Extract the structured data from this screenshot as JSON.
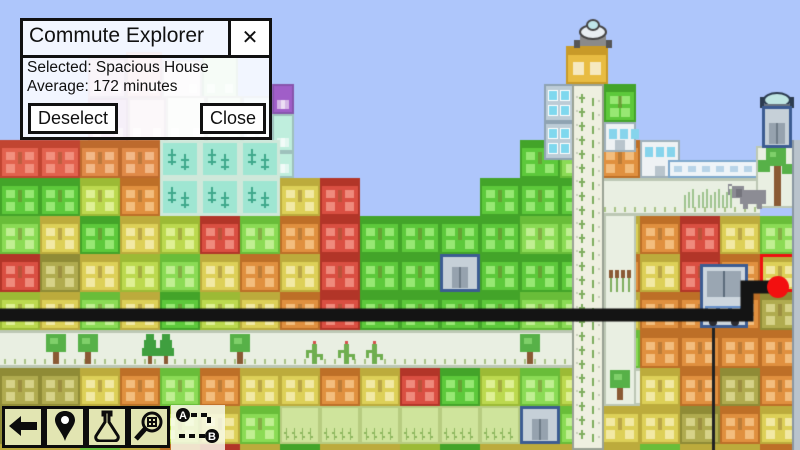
{
  "window": {
    "title": "Commute Explorer",
    "close_x": "✕",
    "selected_line": "Selected: Spacious House",
    "average_line": "Average: 172 minutes",
    "deselect_button": "Deselect",
    "close_button": "Close"
  },
  "toolbar": {
    "buttons": [
      {
        "name": "back"
      },
      {
        "name": "locate-home"
      },
      {
        "name": "research"
      },
      {
        "name": "inspect-building"
      }
    ],
    "ab_icon": {
      "a": "A",
      "b": "B"
    }
  },
  "map": {
    "sky": "#aec6fb",
    "route": {
      "color": "#141414",
      "width": 13,
      "points": [
        [
          0,
          315
        ],
        [
          747,
          315
        ],
        [
          747,
          287
        ],
        [
          770,
          287
        ]
      ],
      "dot": {
        "x": 778,
        "y": 287,
        "r": 11,
        "color": "#f31010"
      },
      "cable": {
        "x": 713,
        "y1": 328,
        "y2": 450,
        "color": "#222222"
      }
    },
    "selected_outline": "#ee1010",
    "palette": {
      "G": {
        "b": "#5dc93b",
        "d": "#43a429",
        "w": "#97e873"
      },
      "g": {
        "b": "#8bdb55",
        "d": "#69bd39",
        "w": "#c0ef92"
      },
      "L": {
        "b": "#bcd94f",
        "d": "#9cba35",
        "w": "#dff094"
      },
      "Y": {
        "b": "#ddd058",
        "d": "#bcab3c",
        "w": "#f2e9a4"
      },
      "o": {
        "b": "#b0ab4f",
        "d": "#8f8b36",
        "w": "#d6d288"
      },
      "O": {
        "b": "#e0903f",
        "d": "#bd6f27",
        "w": "#f3bd7d"
      },
      "R": {
        "b": "#da4f42",
        "d": "#b23528",
        "w": "#ef8a7c"
      },
      "r": {
        "b": "#c43c38",
        "d": "#9c2a27",
        "w": "#e07068"
      },
      "F": {
        "b": "#e2624e",
        "d": "#c14531",
        "w": "#f2907e"
      },
      "f": {
        "b": "#e08a48",
        "d": "#bd6a2d",
        "w": "#f2b887"
      },
      "X": {
        "b": "#ddd058",
        "d": "#bcab3c",
        "w": "#f2e9a4"
      }
    },
    "grid": {
      "cw": 40,
      "rh": 38,
      "y0": 140,
      "cols": [
        "FGgRLBooY",
        "FGYoYBoYY",
        "fLGYgBYog",
        "fOYLYBOgY",
        "TTLgGBgLO",
        "TTRYLBOYR",
        "TTgOYBYgY",
        ".YOYOBYAG",
        ".RRRRBOAY",
        "..GGGBYAY",
        "..GGGBRAL",
        "..GEGBGAG",
        ".GGGGBLAY",
        "GGgGgBgEY",
        "gGgGgBLgY",
        "OBYOYgpYY",
        "WBOYOOYYg",
        ".BRROOOoY",
        ".BYOOOoOY",
        "..gXoOOYO"
      ]
    },
    "decor": [
      {
        "x": 88,
        "y": 58,
        "w": 38,
        "h": 40,
        "c": "#dcc0e0"
      },
      {
        "x": 126,
        "y": 52,
        "w": 36,
        "h": 46,
        "c": "#e8c2ce"
      },
      {
        "x": 162,
        "y": 60,
        "w": 40,
        "h": 38,
        "c": "#efeaf0"
      },
      {
        "x": 202,
        "y": 56,
        "w": 36,
        "h": 42,
        "c": "#c4e8cc"
      },
      {
        "x": 88,
        "y": 98,
        "w": 40,
        "h": 44,
        "c": "#c9a2d8"
      },
      {
        "x": 128,
        "y": 98,
        "w": 38,
        "h": 44,
        "c": "#ecd2de"
      },
      {
        "x": 166,
        "y": 96,
        "w": 40,
        "h": 46,
        "c": "#e9f0e8"
      },
      {
        "x": 206,
        "y": 96,
        "w": 36,
        "h": 46,
        "c": "#d8eedc"
      },
      {
        "x": 242,
        "y": 96,
        "w": 30,
        "h": 46,
        "c": "#cfe4ef"
      },
      {
        "x": 272,
        "y": 84,
        "w": 22,
        "h": 30,
        "c": "#a05ec8"
      },
      {
        "x": 272,
        "y": 114,
        "w": 22,
        "h": 38,
        "c": "#bfeedd"
      },
      {
        "x": 272,
        "y": 152,
        "w": 22,
        "h": 26,
        "c": "#bfeedd"
      }
    ],
    "landmarks": [
      {
        "t": "ktile",
        "x": 544,
        "y": 84,
        "w": 32,
        "h": 38
      },
      {
        "t": "ktile",
        "x": 544,
        "y": 122,
        "w": 32,
        "h": 38
      },
      {
        "t": "cell",
        "c": "G",
        "x": 604,
        "y": 84,
        "w": 32,
        "h": 38
      },
      {
        "t": "cell",
        "c": "W",
        "x": 604,
        "y": 122,
        "w": 32,
        "h": 30
      },
      {
        "t": "shaft",
        "x": 572,
        "y": 84,
        "w": 32,
        "h": 366
      },
      {
        "t": "cap",
        "x": 566,
        "y": 46,
        "w": 42,
        "h": 38
      },
      {
        "t": "statue",
        "x": 572,
        "y": 18
      },
      {
        "t": "pocket",
        "x": 604,
        "y": 214,
        "w": 32,
        "h": 192
      },
      {
        "t": "wall",
        "x": 668,
        "y": 160,
        "w": 100,
        "h": 18
      },
      {
        "t": "treetile",
        "x": 756,
        "y": 146,
        "w": 38,
        "h": 62
      },
      {
        "t": "dome2",
        "x": 762,
        "y": 92
      },
      {
        "t": "cell",
        "c": "E",
        "x": 762,
        "y": 106,
        "w": 30,
        "h": 42
      },
      {
        "t": "strip",
        "x": 792,
        "y": 140,
        "w": 8,
        "h": 310
      },
      {
        "t": "garage",
        "x": 700,
        "y": 264,
        "w": 48,
        "h": 64
      },
      {
        "t": "elephant",
        "x": 740,
        "y": 184
      }
    ],
    "vegetation": [
      {
        "k": "tree",
        "x": 56,
        "y": 364
      },
      {
        "k": "tree",
        "x": 88,
        "y": 364
      },
      {
        "k": "pine",
        "x": 150,
        "y": 364
      },
      {
        "k": "pine",
        "x": 166,
        "y": 364
      },
      {
        "k": "tree",
        "x": 240,
        "y": 364
      },
      {
        "k": "cactus",
        "x": 314,
        "y": 364
      },
      {
        "k": "cactus",
        "x": 346,
        "y": 364
      },
      {
        "k": "cactus",
        "x": 374,
        "y": 364
      },
      {
        "k": "tree",
        "x": 530,
        "y": 364
      },
      {
        "k": "stalks",
        "x": 684,
        "y": 208
      },
      {
        "k": "stalks",
        "x": 698,
        "y": 208
      },
      {
        "k": "stalks",
        "x": 710,
        "y": 208
      },
      {
        "k": "stalks",
        "x": 722,
        "y": 208
      }
    ]
  }
}
